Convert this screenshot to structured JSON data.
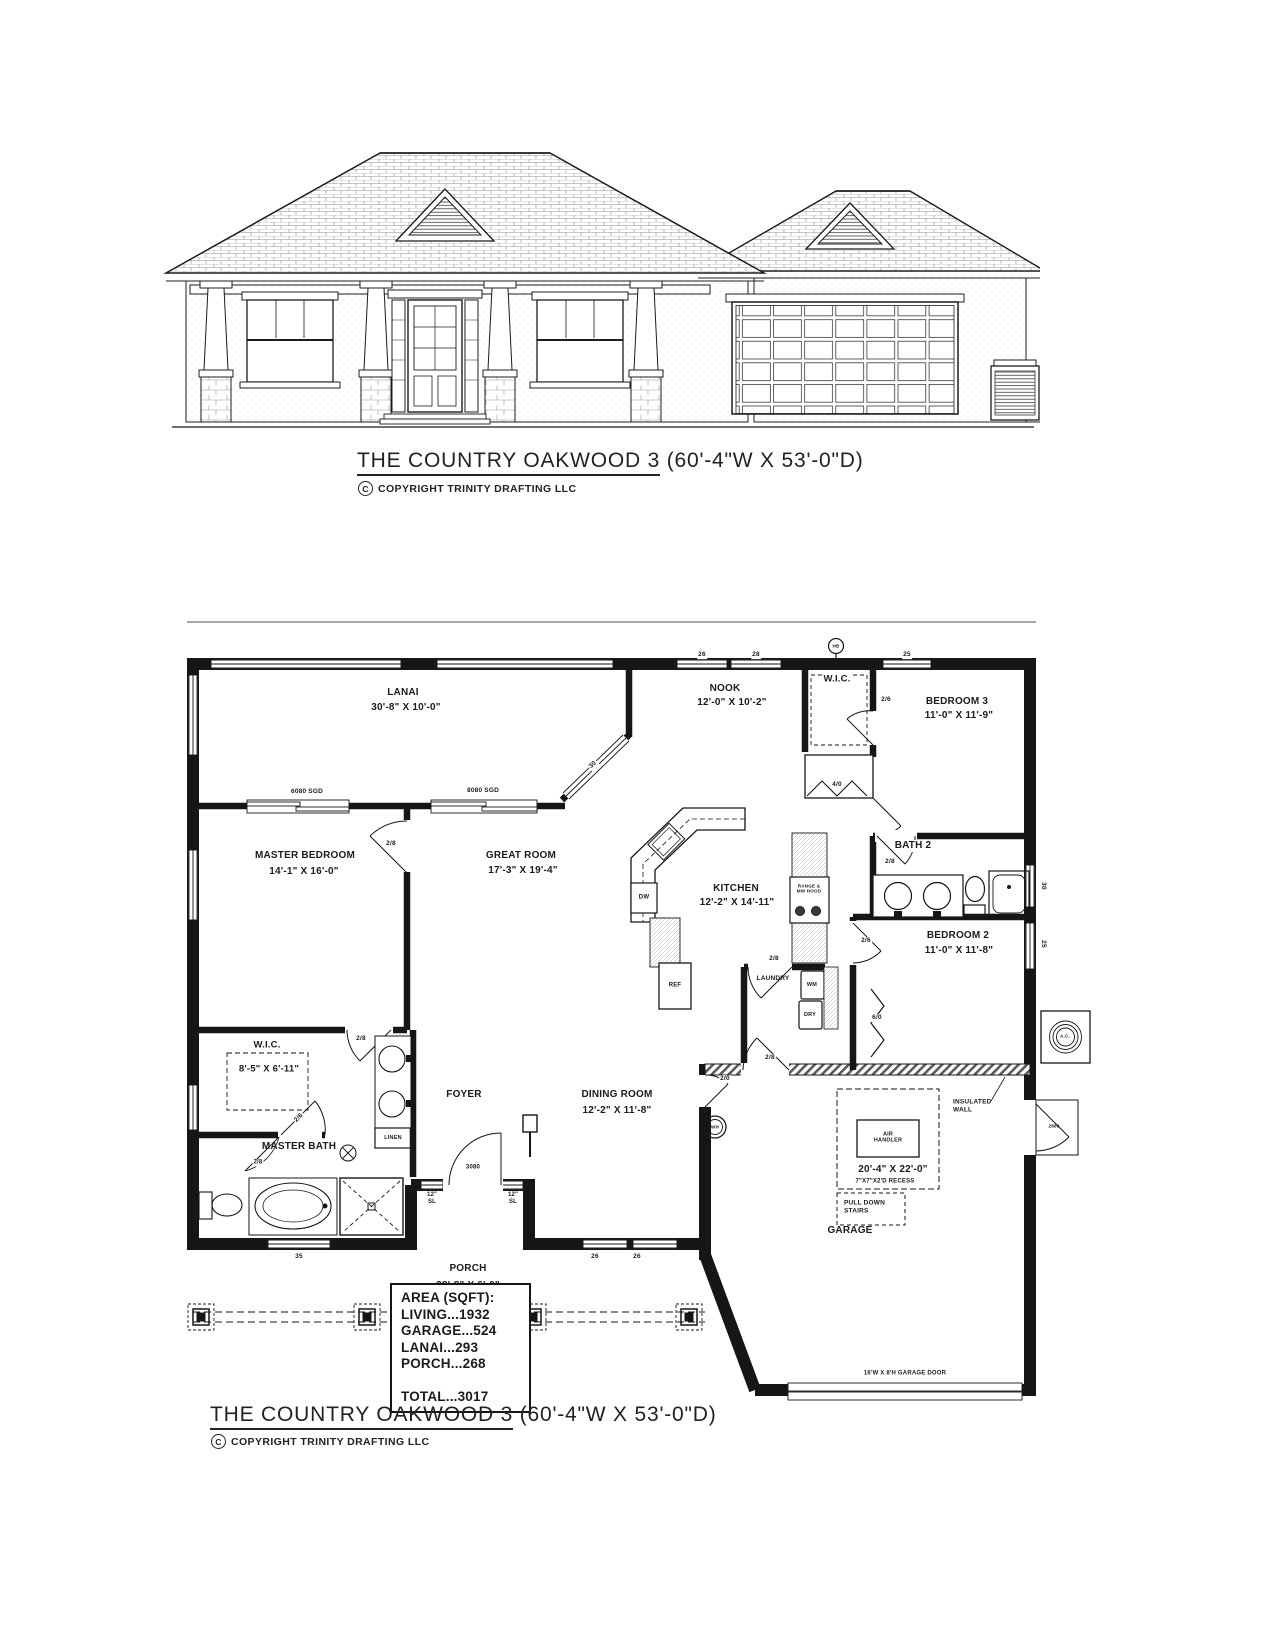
{
  "title": {
    "name": "THE COUNTRY OAKWOOD 3",
    "size": "(60'-4\"W X 53'-0\"D)",
    "copyright_mark": "C",
    "copyright": "COPYRIGHT TRINITY DRAFTING LLC"
  },
  "rooms": {
    "lanai": {
      "name": "LANAI",
      "dims": "30'-8\" X 10'-0\""
    },
    "nook": {
      "name": "NOOK",
      "dims": "12'-0\" X 10'-2\""
    },
    "wic_top": {
      "name": "W.I.C."
    },
    "bedroom3": {
      "name": "BEDROOM 3",
      "dims": "11'-0\" X 11'-9\""
    },
    "master_bedroom": {
      "name": "MASTER BEDROOM",
      "dims": "14'-1\" X 16'-0\""
    },
    "great_room": {
      "name": "GREAT ROOM",
      "dims": "17'-3\" X 19'-4\""
    },
    "kitchen": {
      "name": "KITCHEN",
      "dims": "12'-2\" X 14'-11\""
    },
    "bath2": {
      "name": "BATH 2"
    },
    "bedroom2": {
      "name": "BEDROOM 2",
      "dims": "11'-0\" X 11'-8\""
    },
    "laundry": {
      "name": "LAUNDRY"
    },
    "wic_master": {
      "name": "W.I.C.",
      "dims": "8'-5\" X 6'-11\""
    },
    "foyer": {
      "name": "FOYER"
    },
    "dining_room": {
      "name": "DINING ROOM",
      "dims": "12'-2\" X 11'-8\""
    },
    "master_bath": {
      "name": "MASTER BATH"
    },
    "garage": {
      "name": "GARAGE",
      "dims": "20'-4\" X 22'-0\"",
      "recess": "7\"X7\"X2'D RECESS"
    },
    "porch": {
      "name": "PORCH",
      "dims": "38'-8\" X 6'-0\""
    }
  },
  "fixtures": {
    "dw": "DW",
    "ref": "REF",
    "range": "RANGE &\nMW HOOD",
    "wm": "WM",
    "dry": "DRY",
    "linen": "LINEN",
    "wh": "WH",
    "hb": "HB",
    "ac": "A.C.",
    "air_handler": "AIR\nHANDLER",
    "pull_down_stairs": "PULL DOWN\nSTAIRS"
  },
  "annotations": {
    "sgd_master": "6080 SGD",
    "sgd_great": "8080 SGD",
    "insulated_wall": "INSULATED\nWALL",
    "garage_door": "16'W X 8'H GARAGE DOOR",
    "sidelight": "12\"\nSL"
  },
  "doors": {
    "front": "3080",
    "master_bedroom": "2/8",
    "master_hall": "2/8",
    "master_wic": "2/6",
    "master_bath": "2/8",
    "wic_top": "2/6",
    "bath2": "2/8",
    "bedroom2": "2/6",
    "closet_top": "4/0",
    "closet_bedroom2": "6/0",
    "laundry": "2/8",
    "garage_entry": "2/8",
    "garage_closet": "2/0",
    "exterior_side": "2880"
  },
  "windows": {
    "top_a": "26",
    "top_b": "28",
    "top_bed3": "25",
    "lanai_glass": "30",
    "right_bath2": "30",
    "right_bed2": "25",
    "bottom_bath": "35",
    "bottom_din_a": "26",
    "bottom_din_b": "26"
  },
  "area_table": {
    "title": "AREA (SQFT):",
    "rows": [
      "LIVING...1932",
      "GARAGE...524",
      "LANAI...293",
      "PORCH...268"
    ],
    "total": "TOTAL...3017"
  }
}
